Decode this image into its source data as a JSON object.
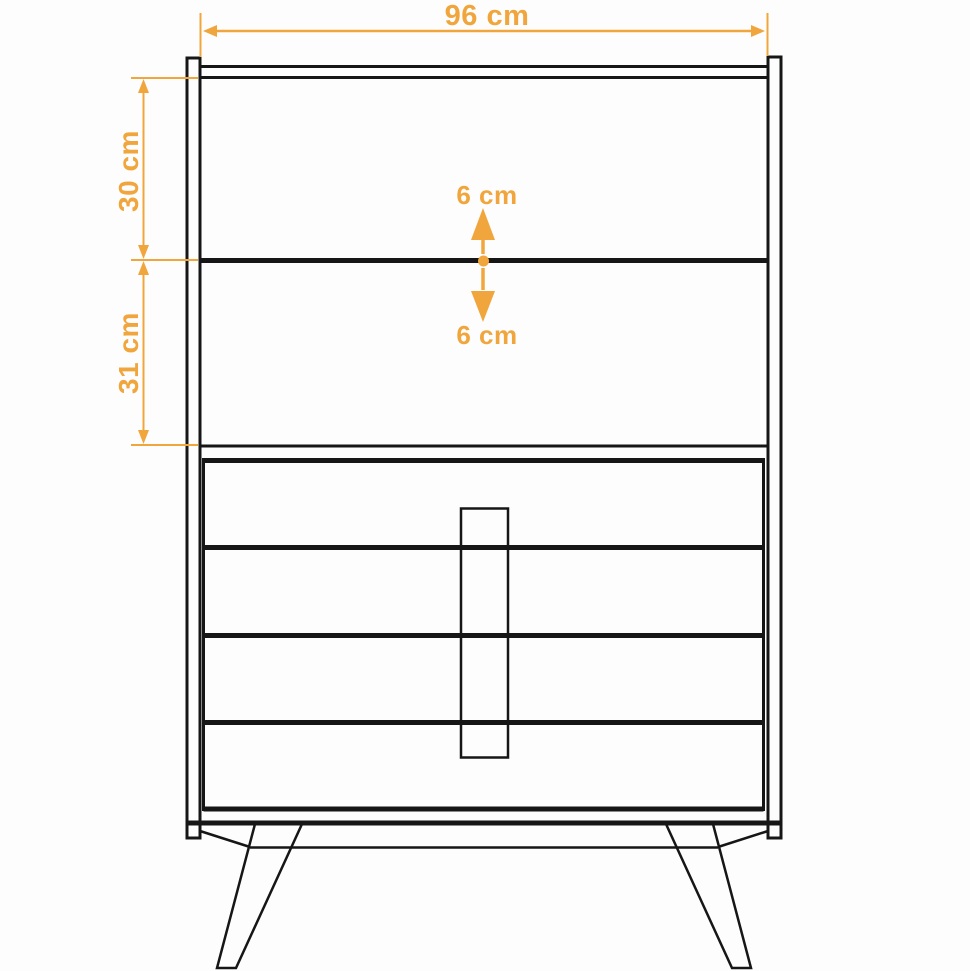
{
  "diagram": {
    "subject": "dresser-front-view-dimension-drawing",
    "description": "Line drawing of a mid-century dresser: top cabinet with two open sections, four lower drawers with a long vertical center handle, splayed tapered legs. Orange dimension annotations.",
    "colors": {
      "accent": "#f0a63c",
      "line": "#161616",
      "background": "#fdfdfd"
    },
    "labels": {
      "total_width": "96 cm",
      "top_section_height": "30 cm",
      "middle_section_height": "31 cm",
      "clearance_above": "6 cm",
      "clearance_below": "6 cm"
    }
  }
}
